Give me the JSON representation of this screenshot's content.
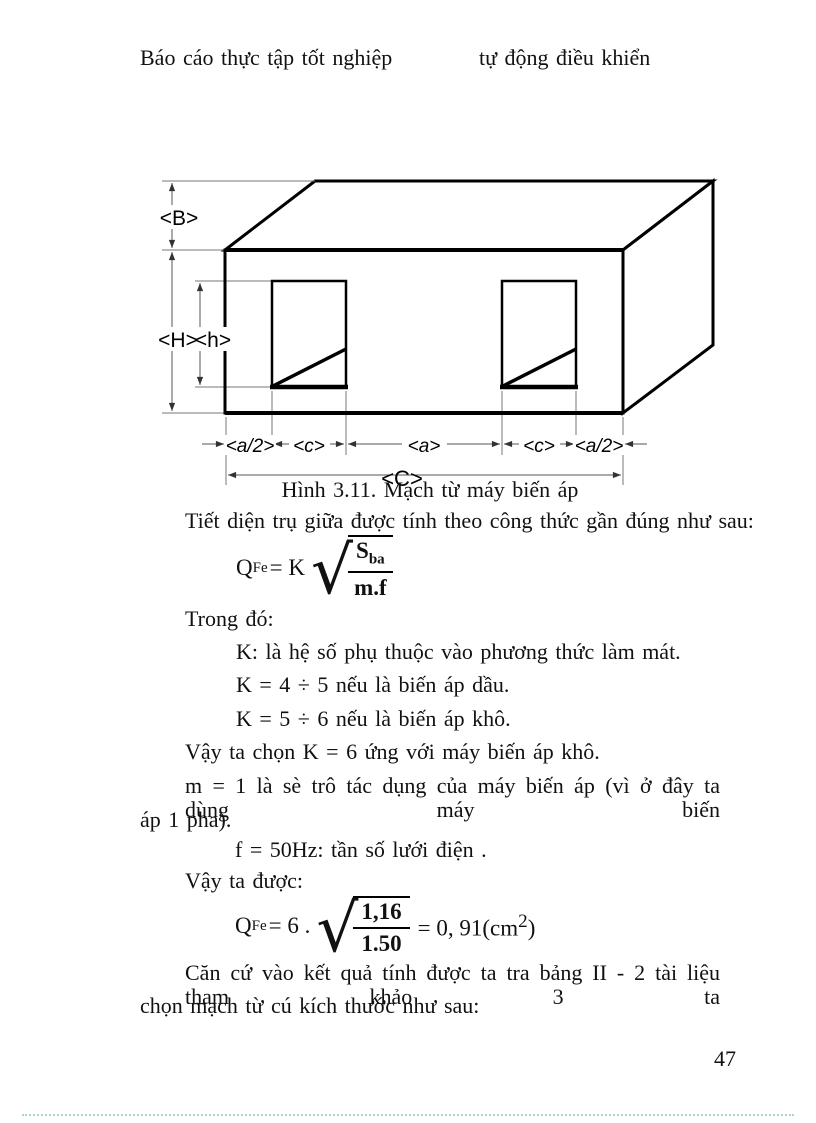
{
  "header": {
    "left": "Báo cáo thực tập tốt nghiệp",
    "right": "tự động điều khiển"
  },
  "figure": {
    "caption": "Hình 3.11. Mạch từ máy biến áp",
    "labels": {
      "B": "<B>",
      "H": "<H>",
      "h": "<h>",
      "a_half": "<a/2>",
      "c": "<c>",
      "a": "<a>",
      "C": "<C>"
    }
  },
  "body": {
    "intro": "Tiết diện trụ giữa được tính theo công thức gần đúng như sau:",
    "where": "Trong đó:",
    "k_desc": "K: là hệ số phụ thuộc vào phương thức làm mát.",
    "k_oil": "K = 4 ÷ 5 nếu là biến áp dầu.",
    "k_dry": "K = 5 ÷ 6 nếu là biến áp khô.",
    "k_choice": "Vậy ta chọn K = 6 ứng với máy biến áp khô.",
    "m_line1": "m = 1 là sè trô tác dụng của máy biến áp (vì ở đây ta dùng máy biến",
    "m_line2": "áp 1 pha).",
    "f_line": "f = 50Hz: tần số lưới điện .",
    "result_intro": "Vậy ta được:",
    "conclusion_line1": "Căn cứ vào kết quả tính được ta tra bảng II - 2 tài liệu tham khảo 3 ta",
    "conclusion_line2": "chọn mạch từ cú kích thước như sau:"
  },
  "formula1": {
    "q": "Q",
    "q_sub": "Fe",
    "eq": "= K",
    "num": "S",
    "num_sub": "ba",
    "den": "m.f"
  },
  "formula2": {
    "q": "Q",
    "q_sub": "Fe",
    "eq": "= 6 .",
    "num": "1,16",
    "den": "1.50",
    "res": "= 0, 91(cm",
    "res_sup": "2",
    "res_end": ")"
  },
  "page_number": "47"
}
